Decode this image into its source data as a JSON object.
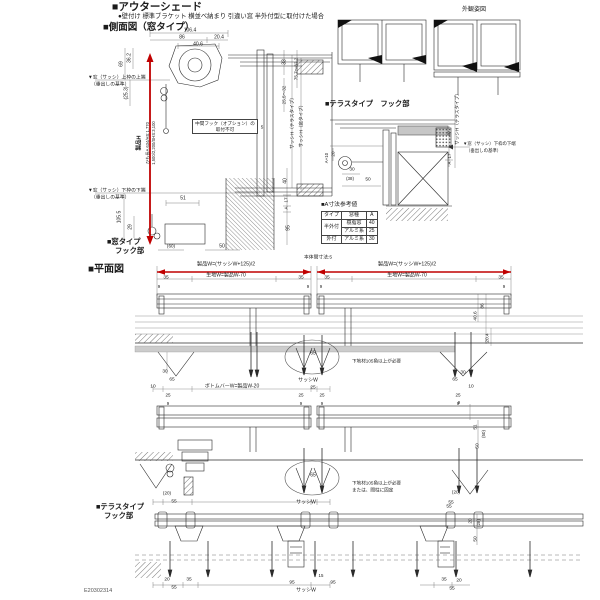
{
  "header": {
    "title": "■アウターシェード",
    "subtitle": "●壁付け 標準ブラケット 横並べ納まり 引違い窓 半外付型に取付けた場合",
    "side_view_title": "■側面図（窓タイプ）"
  },
  "elevation": {
    "title": "外観姿図"
  },
  "side_view": {
    "hook_label_1": "■窓タイプ",
    "hook_label_2": "フック部",
    "note_line1": "中間フック（オプション）の",
    "note_line2": "取付不可",
    "datum_top_1": "▼窓（サッシ）上枠の上端",
    "datum_top_2": "（垂出しの基準）",
    "datum_bottom_1": "▼窓（サッシ）下枠の下端",
    "datum_bottom_2": "（垂出しの基準）",
    "product_h": "製品H",
    "product_note1": "ひも長A 634/HS:1,770",
    "product_note2": "1,500/2,200/SHS:3,100"
  },
  "terrace_view": {
    "title": "■テラスタイプ　フック部",
    "datum_1": "▼窓（サッシ）下枠の下端",
    "datum_2": "（垂出しの基準）"
  },
  "a_table": {
    "title": "■A寸法参考値",
    "col_type": "タイプ",
    "col_window": "窓種",
    "col_a": "A",
    "rows": [
      {
        "type": "半外付",
        "window": "樹脂窓",
        "a": "40"
      },
      {
        "type": "",
        "window": "アルミ系",
        "a": "25"
      },
      {
        "type": "外付",
        "window": "アルミ系",
        "a": "30"
      }
    ]
  },
  "plan": {
    "title": "■平面図",
    "gap": "本体間寸法:5",
    "w_left": "製品W=(サッシW+125)/2",
    "w_right": "製品W=(サッシW+125)/2",
    "fabric_left": "生地W=製品W-70",
    "fabric_right": "生地W=製品W-70",
    "bottom_bar": "ボトムバーW=製品W-20",
    "note1": "下地材105角以上が必要",
    "note2_1": "下地材105角以上が必要",
    "note2_2": "または、間柱に固定",
    "window_hook_1": "■窓タイプ",
    "window_hook_2": "フック部",
    "terrace_hook_1": "■テラスタイプ",
    "terrace_hook_2": "フック部"
  },
  "doc_number": "E20302314",
  "colors": {
    "accent_red": "#c00000",
    "line": "#2b2b2b",
    "gray_fill": "#c8c8c8"
  },
  "dims": {
    "sv_106_4": "106.4",
    "sv_86": "86",
    "sv_20_4": "20.4",
    "sv_40_6": "40.6",
    "sv_36_2": "36.2",
    "sv_69": "69",
    "sv_25_3": "(25.3)",
    "sv_105_5": "105.5",
    "sv_29": "29",
    "sv_51": "51",
    "sv_60p": "(60)",
    "sv_50": "50",
    "sv_5": "5",
    "sv_33": "33",
    "sv_75": "75.7～82.2",
    "sv_25_5": "25.5～32",
    "sv_sash_ter": "サッシH（テラスタイプ）",
    "sv_sash_win": "サッシH（窓タイプ）",
    "sv_40": "40",
    "sv_17": "17",
    "sv_A": "A",
    "sv_95": "95",
    "ter_20": "20",
    "ter_a10": "A+10",
    "ter_30": "30",
    "ter_38": "(38)",
    "ter_50": "50",
    "ter_sash": "サッシH（テラスタイプ）",
    "ter_40": "40",
    "ter_17": "17",
    "ter_A": "A",
    "p_35a": "35",
    "p_35b": "35",
    "p_35c": "35",
    "p_35d": "35",
    "p_9a": "9",
    "p_9b": "9",
    "p_9c": "9",
    "p_9d": "9",
    "s1_30L": "30",
    "s1_65L": "65",
    "s1_10L": "10",
    "s1_25L": "25",
    "s1_65c": "65",
    "s1_sashW": "サッシW",
    "s1_86": "86",
    "s1_40_6": "40.6",
    "s1_20_4": "20.4",
    "s1_30R": "30",
    "s1_65R": "65",
    "s1_10R": "10",
    "s1_p25a": "25",
    "s1_p9a": "9",
    "s1_p25b": "25",
    "s1_p9b": "9",
    "s1_p25c": "25",
    "s1_p9c": "9",
    "s1_p25d": "25",
    "s1_p9d": "9",
    "s2_20p": "(20)",
    "s2_55": "55",
    "s2_65c": "65",
    "s2_sashW": "サッシW",
    "s2_9": "9",
    "s2_51": "51",
    "s2_50p": "(50)",
    "s2_50": "50",
    "s2_20pR": "(20)",
    "s2_55R": "55",
    "s3_55top": "55",
    "s3_20r": "20",
    "s3_28r": "(28)",
    "s3_50r": "50",
    "s3_15": "15",
    "s3_20a": "20",
    "s3_35a": "35",
    "s3_55a": "55",
    "s3_95a": "95",
    "s3_95b": "95",
    "s3_sashW": "サッシW",
    "s3_35b": "35",
    "s3_20b": "20",
    "s3_55b": "55"
  }
}
